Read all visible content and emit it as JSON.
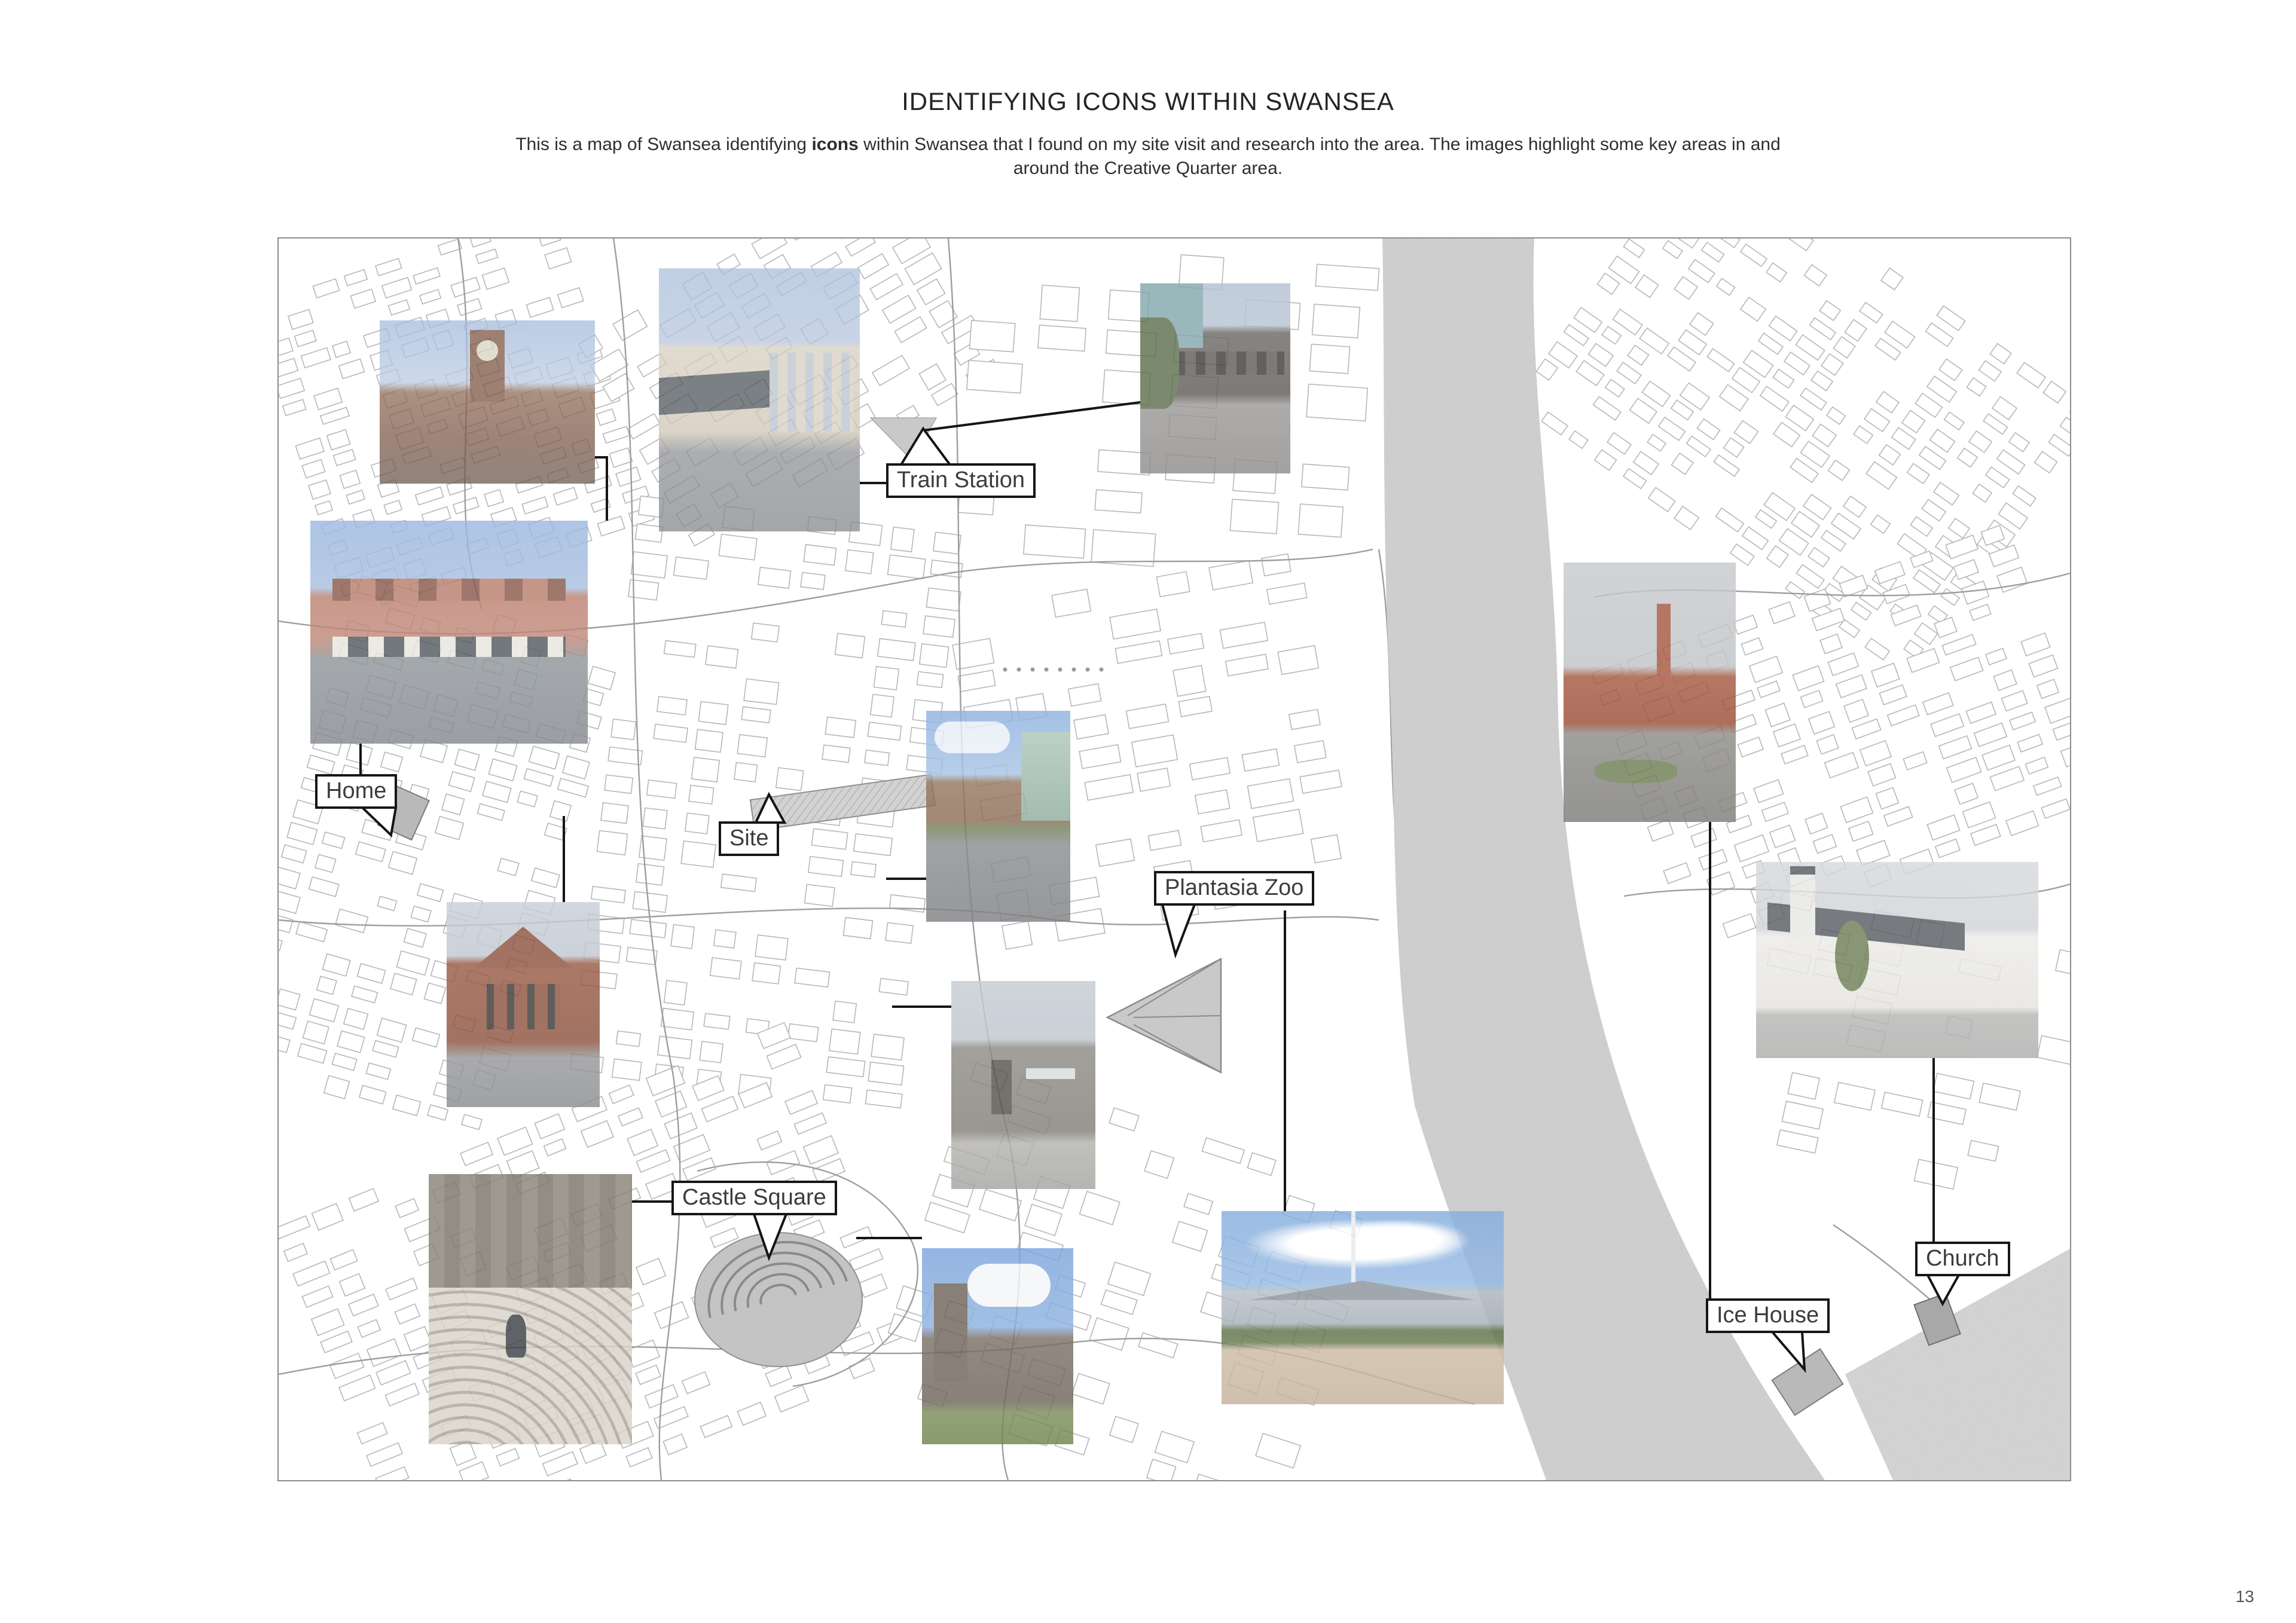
{
  "header": {
    "title": "IDENTIFYING ICONS WITHIN SWANSEA",
    "subtitle": {
      "before": "This is a map of Swansea identifying ",
      "bold": "icons",
      "after": " within Swansea that I found on my site visit and research into the area. The images highlight some key areas in and around the Creative Quarter area."
    }
  },
  "map": {
    "labels": {
      "train_station": "Train Station",
      "home": "Home",
      "site": "Site",
      "plantasia": "Plantasia Zoo",
      "castle_square": "Castle Square",
      "ice_house": "Ice House",
      "church": "Church"
    },
    "photos": {
      "clock_tower": "Red-brick clock tower building against blue sky",
      "train_station": "Swansea railway station entrance with canopy",
      "viaduct": "Dark stone railway viaduct arches with greenery",
      "high_street_terrace": "Red-brick terraced buildings along a wide road",
      "site_buildings": "Brick offices beside a green glass building at the site",
      "red_brick_building": "Red-brick gabled building",
      "concrete_building": "Grey concrete building facade",
      "pump_house": "Red-brick pump house with chimney beside the river",
      "norwegian_church": "White timber church with grey roof and flagpoles",
      "castle_steps": "Curved amphitheatre steps below castle walls",
      "castle_ruins": "Swansea Castle ruins with grass in foreground",
      "plantasia": "Glass pyramid building of Plantasia with plaza"
    }
  },
  "footer": {
    "page_number": "13"
  }
}
